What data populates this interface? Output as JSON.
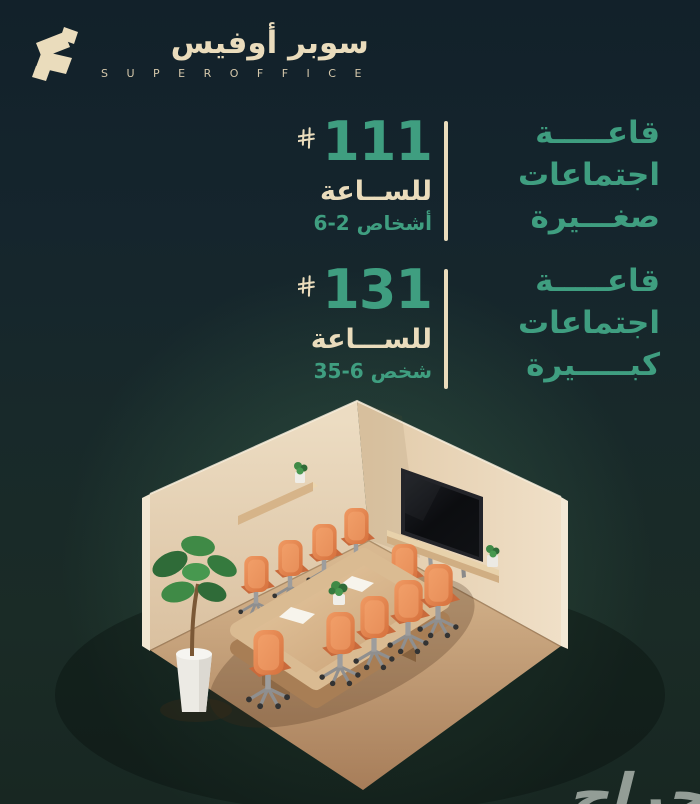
{
  "brand": {
    "name_ar": "سوبر أوفيس",
    "name_en": "S U P E R   O F F I C E",
    "icon": "super-office-s-mark"
  },
  "offers": [
    {
      "title_lines": [
        "قاعـــــة",
        "اجتماعات",
        "صغـــيرة"
      ],
      "price": "111",
      "currency_icon": "saudi-riyal-symbol",
      "unit": "للســاعة",
      "capacity": "6-2 أشخاص"
    },
    {
      "title_lines": [
        "قاعـــــة",
        "اجتماعات",
        "كبـــــيرة"
      ],
      "price": "131",
      "currency_icon": "saudi-riyal-symbol",
      "unit": "للســـاعة",
      "capacity": "35-6 شخص"
    }
  ],
  "watermark": "حراج",
  "colors": {
    "accent_green": "#3f9e80",
    "cream": "#eadcbc",
    "background_top": "#12212a",
    "background_bottom": "#1a2b26",
    "glow_green": "#2e4d3b",
    "wall_cream": "#ead9bf",
    "floor_tan": "#c9a47c",
    "chair_orange": "#e8834f",
    "watermark_grey": "#a9b2ab"
  },
  "illustration": {
    "description": "isometric 3D render of a meeting room",
    "chair_count": 10,
    "elements": [
      "wall-shelf-with-small-plant",
      "tv-screen-on-right-wall",
      "media-shelf-with-small-plant",
      "wooden-conference-table",
      "orange-office-chairs",
      "tall-potted-plant",
      "two-paper-sheets-on-table",
      "table-centerpiece-plant"
    ]
  }
}
